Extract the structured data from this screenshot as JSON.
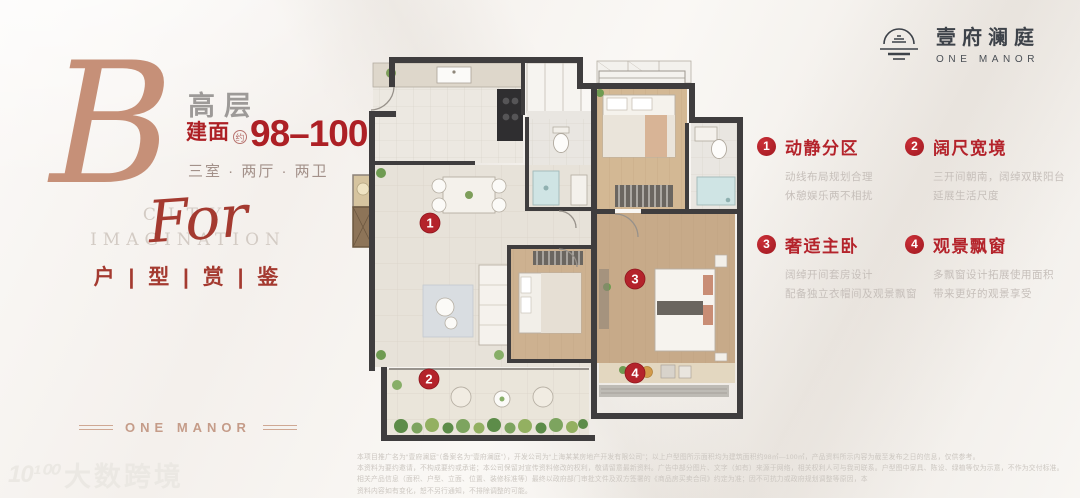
{
  "brand": {
    "name_cn": "壹府澜庭",
    "name_en": "ONE MANOR"
  },
  "left_panel": {
    "plan_letter": "B",
    "floor_tag": "高层",
    "area_label": "建面",
    "area_note": "约",
    "area_value": "98–100",
    "area_unit": "m²",
    "layout_text": "三室 · 两厅 · 两卫",
    "slogan_line1": "CITY",
    "slogan_line2": "IMAGINATION",
    "slogan_script": "For",
    "review_title": "户 | 型 | 赏 | 鉴",
    "footer_brand": "ONE MANOR"
  },
  "plan": {
    "markers": [
      "1",
      "2",
      "3",
      "4"
    ]
  },
  "features": [
    {
      "num": "1",
      "title": "动静分区",
      "line1": "动线布局规划合理",
      "line2": "休憩娱乐两不相扰"
    },
    {
      "num": "2",
      "title": "阔尺宽境",
      "line1": "三开间朝南，阔绰双联阳台",
      "line2": "延展生活尺度"
    },
    {
      "num": "3",
      "title": "奢适主卧",
      "line1": "阔绰开间套房设计",
      "line2": "配备独立衣帽间及观景飘窗"
    },
    {
      "num": "4",
      "title": "观景飘窗",
      "line1": "多飘窗设计拓展使用面积",
      "line2": "带来更好的观景享受"
    }
  ],
  "disclaimer": {
    "line1": "本项目推广名为“壹府澜庭”（备案名为“壹府澜庭”），开发公司为“上海某某房地产开发有限公司”；以上户型图所示面积均为建筑面积约98㎡—100㎡，产品资料所示内容为截至发布之日的信息，仅供参考。",
    "line2": "本资料为要约邀请，不构成要约或承诺；本公司保留对宣传资料修改的权利，敬请留意最新资料。广告中部分图片、文字（如有）来源于网络，相关权利人可与我司联系。户型图中家具、陈设、绿植等仅为示意，不作为交付标准。",
    "line3": "相关产品信息（面积、户型、立面、位置、装修标准等）最终以政府部门审批文件及双方签署的《商品房买卖合同》约定为准；因不可抗力或政府规划调整等原因，本",
    "line4": "资料内容如有变化，恕不另行通知，不排除调整的可能。"
  },
  "watermark": {
    "logo": "10¹⁰⁰",
    "text": "大数跨境"
  },
  "colors": {
    "accent_red": "#b4232b",
    "rose_gold": "#c69078",
    "charcoal": "#3d4249"
  }
}
